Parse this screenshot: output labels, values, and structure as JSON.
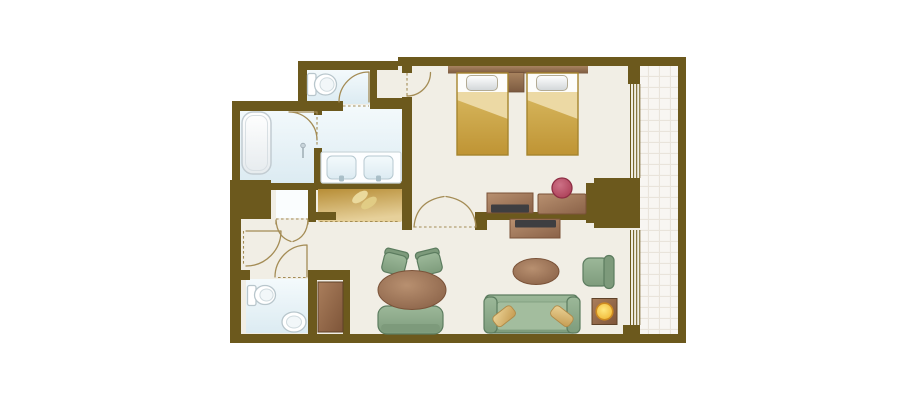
{
  "colors": {
    "wall": "#6c591d",
    "door": "#a48c55",
    "floor": "#f1eee5",
    "bath_light": "#f4fafc",
    "bath_dark": "#dcebf2",
    "alcove": "#fafdfe",
    "balcony": "#f8f6f2",
    "grid": "#e9e4db",
    "fix": "#b8c6cc",
    "tub_line": "#c2ccd2",
    "counter_line": "#ccd7db",
    "wood_light": "#b89070",
    "wood_dark": "#8a6248",
    "wood_line": "#7a5238",
    "hb_light": "#a8835f",
    "hb_dark": "#7c5a40",
    "bed_light": "#d7b75e",
    "bed_dark": "#bf9434",
    "bed_line": "#a5842d",
    "fold": "#ecd9a4",
    "pillow_light": "#ffffff",
    "pillow_dark": "#d2d6d8",
    "pillow_line": "#b3ab94",
    "closet_light": "#e6d09a",
    "closet_dark": "#b68c34",
    "cab_light": "#aa7e5c",
    "cab_dark": "#7e5539",
    "green_light": "#9cb899",
    "green_dark": "#7e9c7c",
    "green_line": "#5c7c5f",
    "green_back": "#7d9a7b",
    "green_seat": "#a3bd9e",
    "pink_light": "#cd7186",
    "pink_dark": "#a83a52",
    "pink_line": "#8e2e44",
    "tan_light": "#ecd498",
    "tan_dark": "#c49a50",
    "tan_line": "#b08a48",
    "yellow_light": "#ffe87e",
    "yellow_dark": "#eeb02a",
    "yellow_ring": "#cd8a20",
    "tv": "#3e3e41"
  },
  "floorplan": {
    "type": "hotel-guest-room-floor-plan",
    "rooms": [
      "bedroom",
      "living-area",
      "bathtub-room",
      "vanity-room",
      "toilet-room-1",
      "toilet-room-2",
      "entry-corridor",
      "wardrobe-closet",
      "balcony"
    ],
    "furniture": [
      "twin-bed-1",
      "twin-bed-2",
      "nightstand",
      "headboard",
      "tv-cabinet-bedroom",
      "tv-cabinet-living",
      "dressing-table",
      "dressing-stool",
      "sofa",
      "sofa-pillow-1",
      "sofa-pillow-2",
      "coffee-table",
      "armchair",
      "floor-lamp",
      "dining-table",
      "dining-chair-1",
      "dining-chair-2",
      "dining-bench",
      "bathtub",
      "shower-head",
      "vanity-counter",
      "sink-1",
      "sink-2",
      "toilet-1",
      "toilet-2",
      "hand-basin",
      "luggage-cabinet"
    ],
    "doors": [
      "entry-door",
      "bifold-closet-door",
      "toilet-2-door",
      "toilet-1-door",
      "bedroom-alcove-door",
      "bathroom-door",
      "double-door-bedroom-living"
    ],
    "windows": [
      "bedroom-window",
      "living-room-window"
    ]
  }
}
